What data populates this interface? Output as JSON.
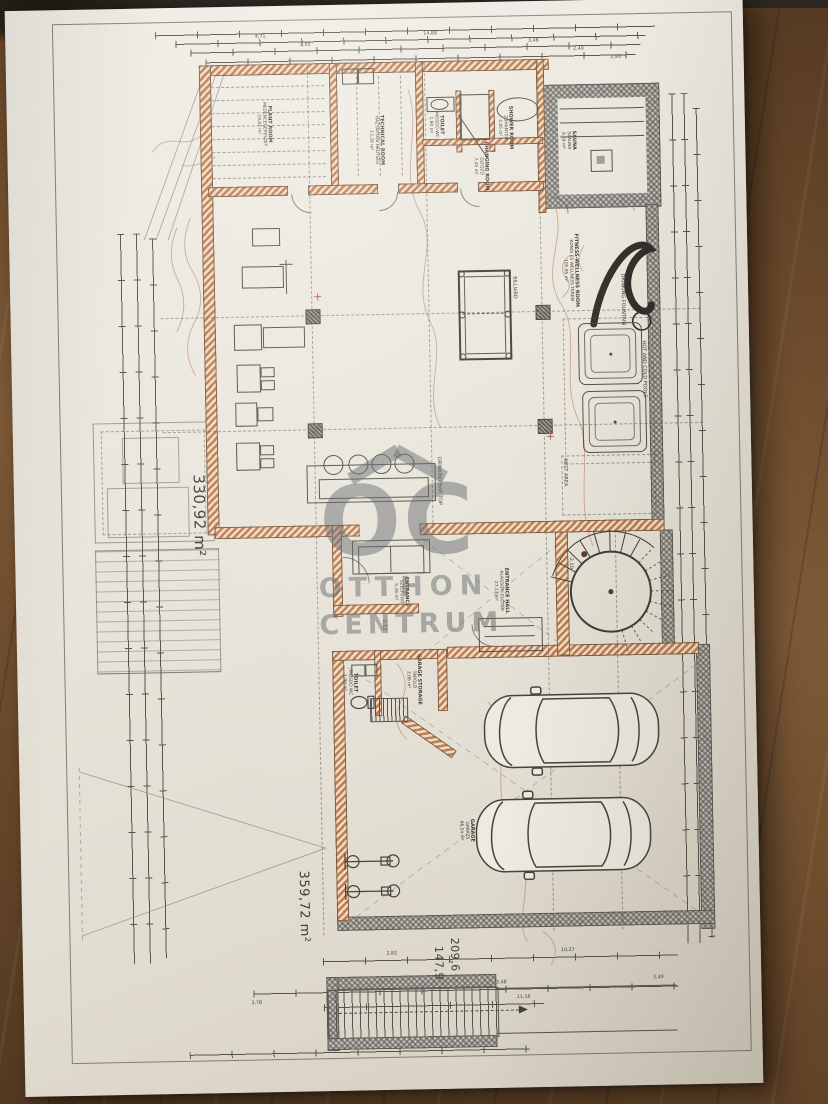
{
  "scene": {
    "description": "Photographed architectural basement floor plan on a wooden desk",
    "colors": {
      "wood": "#6b4a2b",
      "paper": "#eae6dc",
      "wall_accent": "#c07a4e",
      "gray_wall": "#8f8d88",
      "ink": "#4d4b43",
      "contour": "#bf8e74",
      "watermark": "#5e6266"
    }
  },
  "watermark": {
    "logo": "OC",
    "line1": "OTTHON",
    "line2": "CENTRUM"
  },
  "areas": {
    "wellness_level_total": "330,92 m²",
    "garage_level_total": "359,72 m²",
    "overall_dim_1": "209,6",
    "overall_dim_2": "147,9"
  },
  "rooms": {
    "plant": {
      "en": "PLANT ROOM",
      "hu": "MEDENCEGÉPÉSZET",
      "area": "19,87 m²"
    },
    "technical": {
      "en": "TECHNICAL ROOM",
      "hu": "HÁZTARTÁSI HELYISÉG",
      "area": "13,39 m²"
    },
    "toilet_top": {
      "en": "TOILET",
      "hu": "MOSDÓ-WC",
      "area": "1,90 m²"
    },
    "shower": {
      "en": "SHOWER ROOM",
      "hu": "ZUHANYZÓ",
      "area": "4,85 m²"
    },
    "changing": {
      "en": "CHANGING ROOM",
      "hu": "ÖLTÖZŐ",
      "area": "7,45 m²"
    },
    "sauna": {
      "en": "SAUNA",
      "hu": "SZAUNA",
      "area": "9,58 m²"
    },
    "fitness": {
      "en": "FITNESS-WELLNESS ROOM",
      "hu": "KONDI ÉS WELLNESS TEREM",
      "area": "105,95 m²"
    },
    "entrance": {
      "en": "ENTRANCE",
      "hu": "SZÉLFOGÓ",
      "area": "5,36 m²"
    },
    "hall": {
      "en": "ENTRANCE HALL",
      "hu": "ALAGSORI ELŐTÉR",
      "area": "27,13 m²"
    },
    "toilet_garage": {
      "en": "TOILET",
      "hu": "MOSDÓ WC",
      "area": "1,90 m²"
    },
    "storage": {
      "en": "GARAGE STORAGE",
      "hu": "TÁROLÓ",
      "area": "2,06 m²"
    },
    "garage": {
      "en": "GARAGE",
      "hu": "GARÁZS",
      "area": "66,54 m²"
    }
  },
  "features": {
    "billiard": "BILLIARD",
    "bar": "DRINKING BAR TOP",
    "fountain": "DRINKING FOUNTAIN",
    "pools": "HOT AND COLD POOLS",
    "rest": "REST AREA"
  },
  "levels": {
    "entrance": "-2,12",
    "stair": "-2,10"
  },
  "dims": {
    "top": [
      "4,71",
      "3,05",
      "14,88",
      "3,48",
      "2,40",
      "2,93"
    ],
    "bottom": [
      "3,78",
      "2,82",
      "2,21",
      "3,48",
      "10,27",
      "11,16",
      "3,49"
    ]
  }
}
